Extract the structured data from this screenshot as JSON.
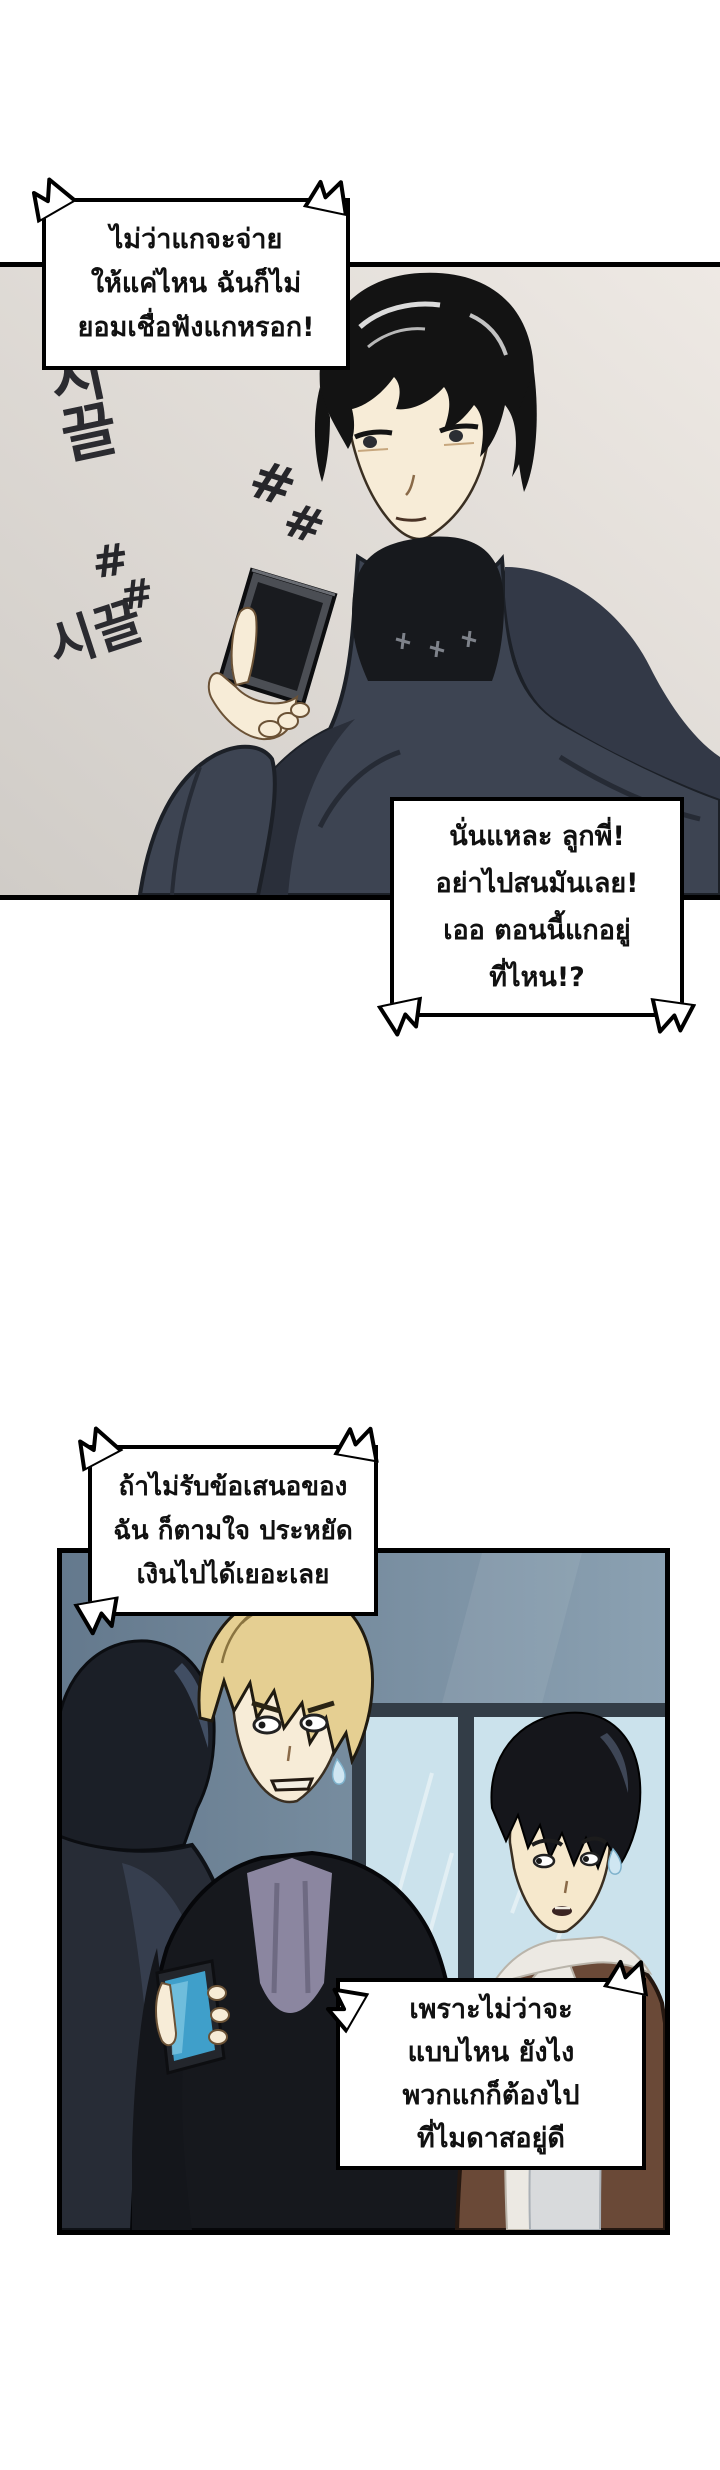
{
  "bubbles": {
    "b1": {
      "lines": [
        "ไม่ว่าแกจะจ่าย",
        "ให้แค่ไหน ฉันก็ไม่",
        "ยอมเชื่อฟังแกหรอก!"
      ]
    },
    "b2": {
      "lines": [
        "นั่นแหละ ลูกพี่!",
        "อย่าไปสนมันเลย!",
        "เออ ตอนนี้แกอยู่",
        "ที่ไหน!?"
      ]
    },
    "b3": {
      "lines": [
        "ถ้าไม่รับข้อเสนอของ",
        "ฉัน ก็ตามใจ ประหยัด",
        "เงินไปได้เยอะเลย"
      ]
    },
    "b4": {
      "lines": [
        "เพราะไม่ว่าจะ",
        "แบบไหน ยังไง",
        "พวกแกก็ต้องไป",
        "ที่ไมดาสอยู่ดี"
      ]
    }
  },
  "sfx": {
    "korean_noise_top": "시끌",
    "korean_noise_bottom": "시끌",
    "hash": "#"
  },
  "colors": {
    "page_bg": "#ffffff",
    "panel1_bg_light": "#eee9e4",
    "panel1_bg_dark": "#d0ccc7",
    "cloak": "#3d4452",
    "cloak_shadow": "#2a2f3a",
    "collar_black": "#17191d",
    "skin": "#f7ecd7",
    "hair_black": "#131313",
    "phone1_frame": "#4b4e54",
    "phone1_screen": "#191b1f",
    "panel2_wall_dark": "#64798d",
    "panel2_wall_light": "#8ba1b2",
    "window_pane": "#cbe2ec",
    "window_frame": "#333d47",
    "blond_hair": "#e5cf92",
    "jacket_black": "#16181d",
    "shirt_purple": "#8b86a0",
    "phone2_screen": "#3f9fca",
    "brown_jacket": "#6a4937",
    "shearling": "#ece9e3",
    "shirt_light": "#d8dadc",
    "silhouette": "#272c36",
    "outline": "#000000"
  }
}
